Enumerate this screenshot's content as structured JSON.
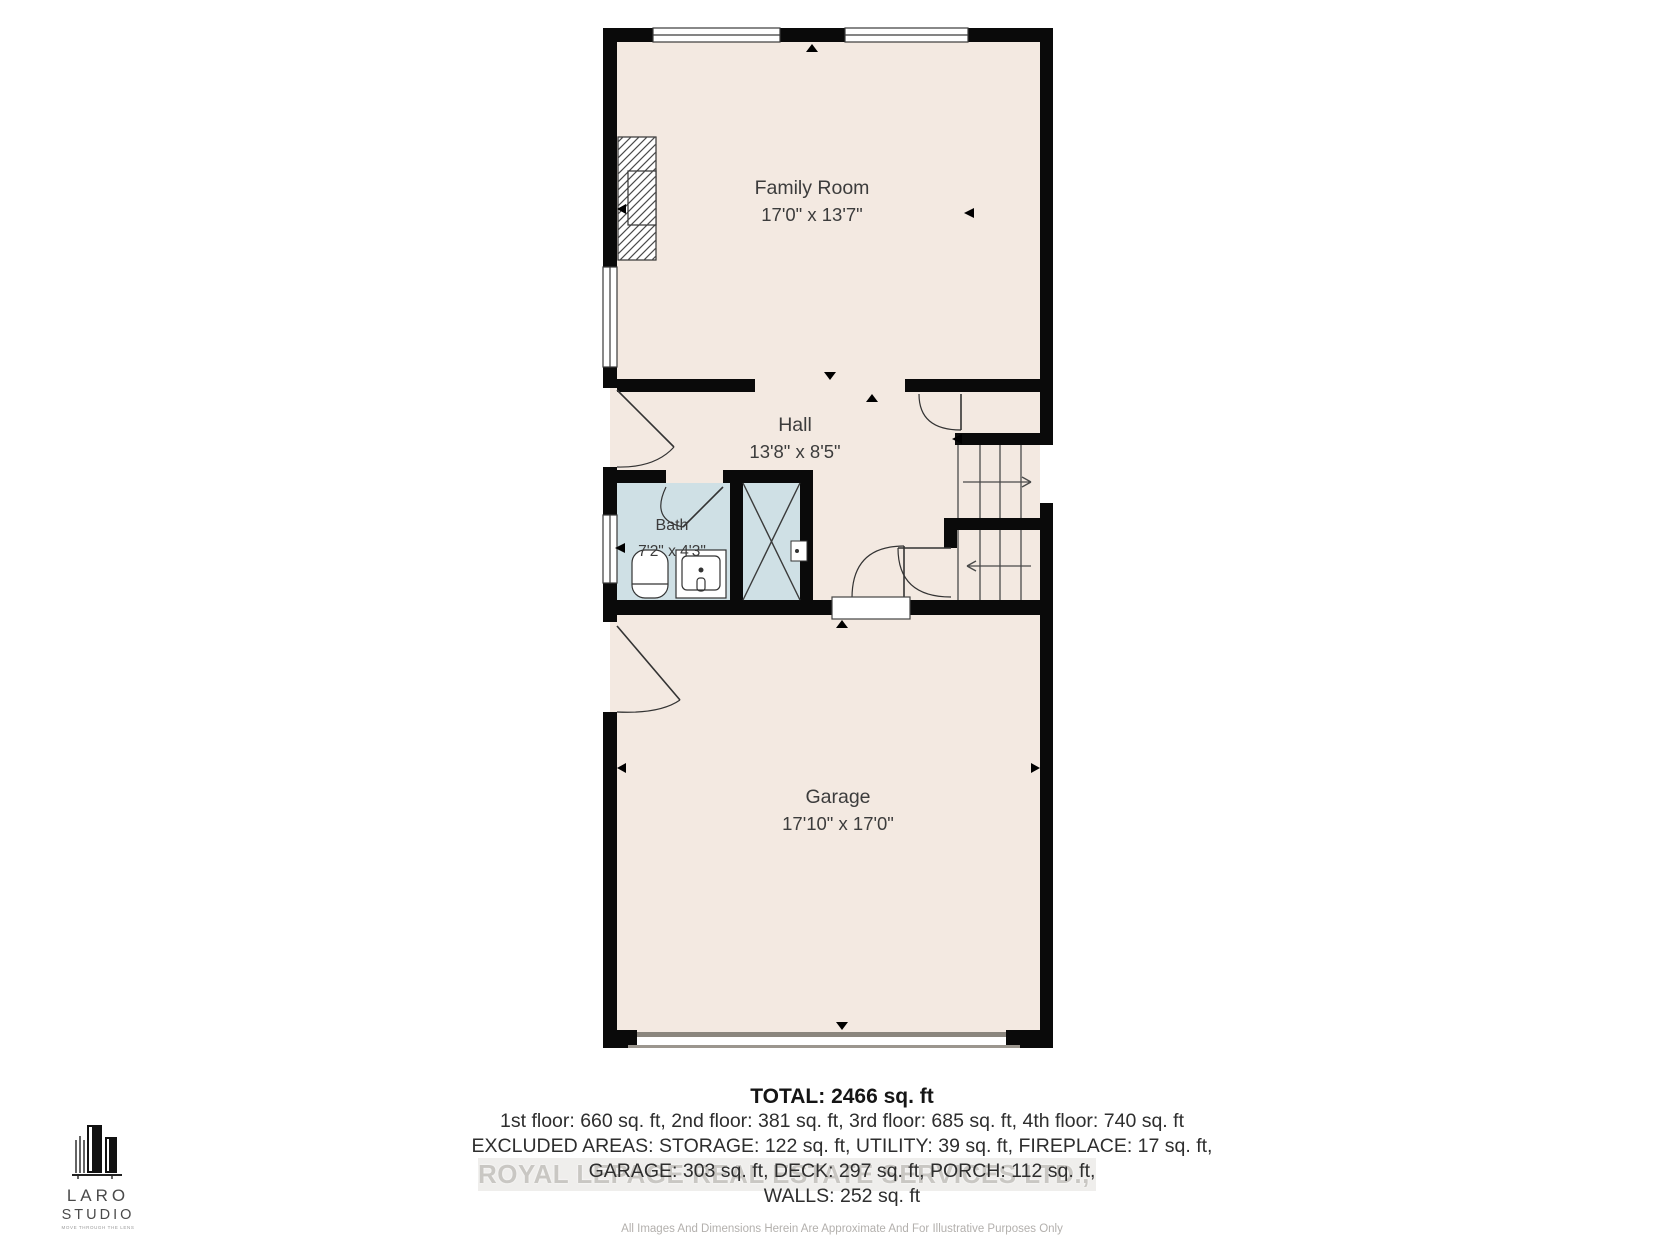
{
  "plan": {
    "rooms": [
      {
        "name": "Family Room",
        "dims": "17'0\" x 13'7\""
      },
      {
        "name": "Hall",
        "dims": "13'8\" x 8'5\""
      },
      {
        "name": "Bath",
        "dims": "7'2\" x 4'3\""
      },
      {
        "name": "Garage",
        "dims": "17'10\" x 17'0\""
      }
    ],
    "colors": {
      "floor": "#f3e9e1",
      "bath": "#cfe0e5",
      "wall": "#0a0a0a",
      "garage_door": "#8b867e"
    }
  },
  "summary": {
    "total": "TOTAL: 2466 sq. ft",
    "floors": "1st floor: 660 sq. ft, 2nd floor: 381 sq. ft, 3rd floor: 685 sq. ft, 4th floor: 740 sq. ft",
    "excluded": "EXCLUDED AREAS: STORAGE: 122 sq. ft, UTILITY: 39 sq. ft, FIREPLACE: 17 sq. ft,",
    "excluded2": "GARAGE: 303 sq. ft, DECK: 297 sq. ft, PORCH: 112 sq. ft,",
    "walls": "WALLS: 252 sq. ft"
  },
  "watermark": {
    "text": "ROYAL LEPAGE REAL ESTATE SERVICES LTD., Brokerage"
  },
  "disclaimer": "All Images And Dimensions Herein Are Approximate And For Illustrative Purposes Only",
  "logo": {
    "name_top": "LARO",
    "name_bottom": "STUDIO",
    "tagline": "MOVE THROUGH THE LENS"
  }
}
